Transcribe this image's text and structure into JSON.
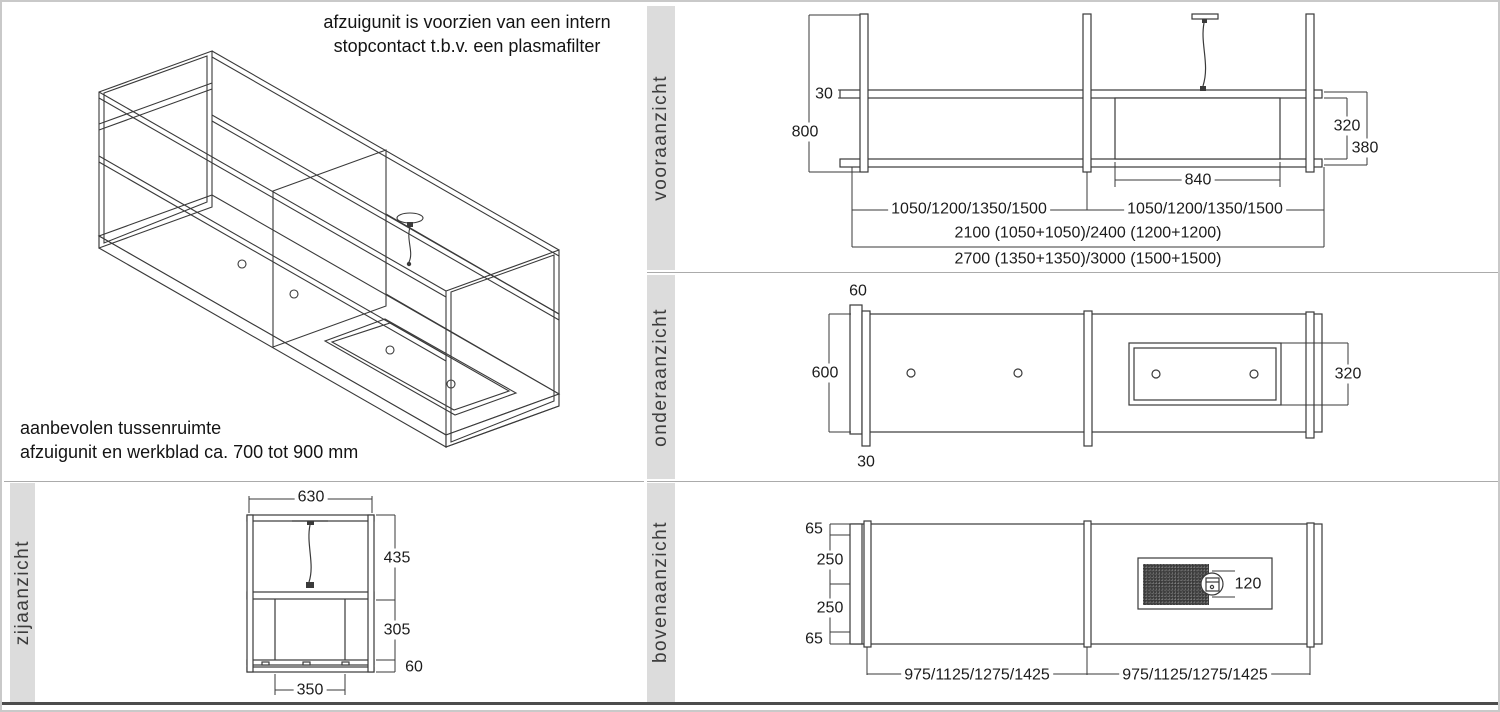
{
  "colors": {
    "line": "#3a3a3a",
    "sidebar_bg": "#dcdcdc",
    "divider": "#ababab",
    "bottom_rule": "#4c4c4c"
  },
  "iso_panel": {
    "note_line1": "afzuigunit is voorzien van een intern",
    "note_line2": "stopcontact t.b.v. een plasmafilter",
    "hint_line1": "aanbevolen tussenruimte",
    "hint_line2": "afzuigunit en werkblad ca. 700 tot 900 mm"
  },
  "views": {
    "front": {
      "label": "vooraanzicht",
      "dims": {
        "rail_height": "30",
        "frame_height": "800",
        "unit_height": "320",
        "unit_total_height": "380",
        "unit_width": "840",
        "bay_left": "1050/1200/1350/1500",
        "bay_right": "1050/1200/1350/1500",
        "totals_a": "2100 (1050+1050)/2400 (1200+1200)",
        "totals_b": "2700 (1350+1350)/3000 (1500+1500)"
      }
    },
    "under": {
      "label": "onderaanzicht",
      "dims": {
        "rail_width": "60",
        "depth": "600",
        "post_width": "30",
        "filter_depth": "320"
      }
    },
    "top": {
      "label": "bovenaanzicht",
      "dims": {
        "edge_top": "65",
        "gap_top": "250",
        "gap_bottom": "250",
        "edge_bottom": "65",
        "duct_diameter": "120",
        "bay_left": "975/1125/1275/1425",
        "bay_right": "975/1125/1275/1425"
      }
    },
    "side": {
      "label": "zijaanzicht",
      "dims": {
        "width": "630",
        "upper_height": "435",
        "lower_height": "305",
        "rail_height": "60",
        "inner_width": "350"
      }
    }
  }
}
